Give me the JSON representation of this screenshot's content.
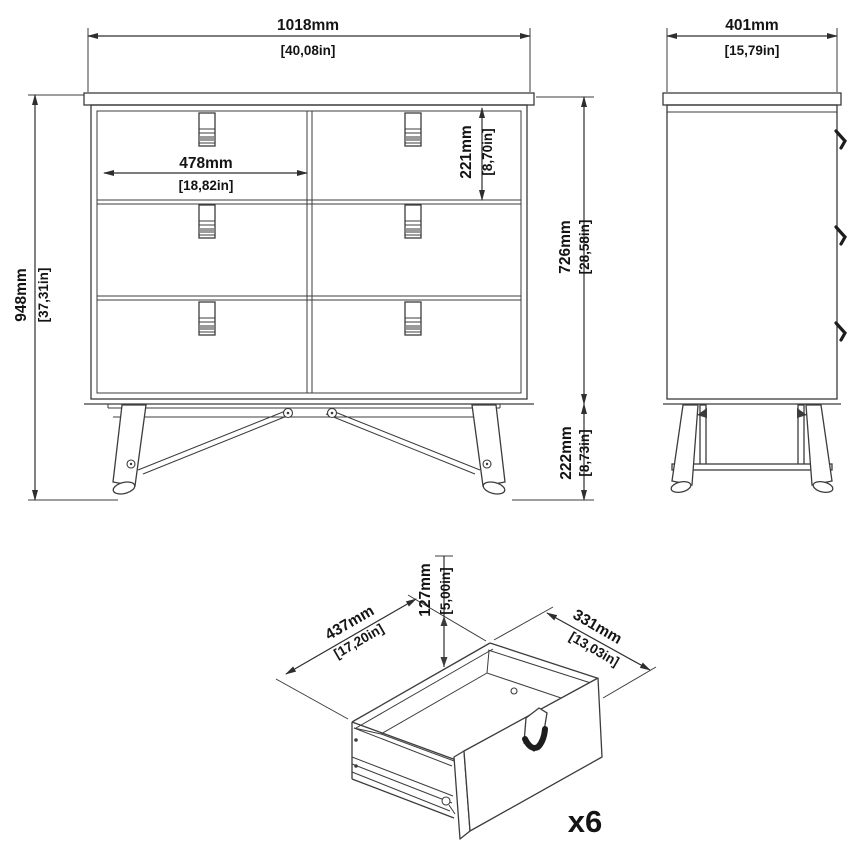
{
  "drawing_title": "6-drawer dresser dimension drawing",
  "colors": {
    "line": "#3c3c3c",
    "text": "#141414",
    "background": "#ffffff"
  },
  "dims": {
    "front": {
      "width_mm": "1018mm",
      "width_in": "[40,08in]",
      "height_mm": "948mm",
      "height_in": "[37,31in]",
      "drawer_w_mm": "478mm",
      "drawer_w_in": "[18,82in]",
      "drawer_h_mm": "221mm",
      "drawer_h_in": "[8,70in]",
      "body_mm": "726mm",
      "body_in": "[28,58in]",
      "legs_mm": "222mm",
      "legs_in": "[8,73in]"
    },
    "side": {
      "depth_mm": "401mm",
      "depth_in": "[15,79in]"
    },
    "drawer": {
      "depth_mm": "437mm",
      "depth_in": "[17,20in]",
      "width_mm": "331mm",
      "width_in": "[13,03in]",
      "height_mm": "127mm",
      "height_in": "[5,00in]",
      "qty": "x6"
    }
  }
}
